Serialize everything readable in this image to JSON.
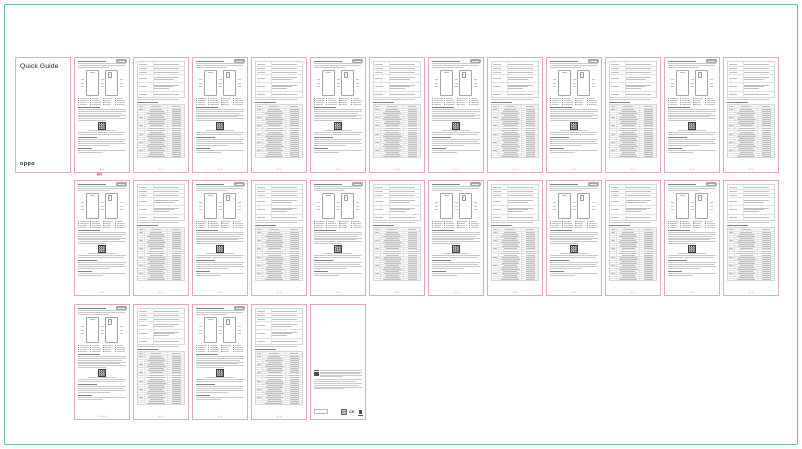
{
  "document": {
    "title": "Quick Guide"
  },
  "cover": {
    "title": "Quick Guide",
    "brand": "oppo"
  },
  "language_marker": {
    "text": "EN"
  },
  "footers": {
    "diagram": "1 / 2",
    "specs": "2 / 2",
    "multi": "1 / 2 / 3"
  },
  "regulatory": {
    "ce_mark": "CE"
  },
  "colors": {
    "frame_green": "#72bd9d",
    "page_border_pink": "#e8aab1",
    "marker_red": "#d93832",
    "language_tab_gray": "#a5a5a5"
  },
  "layout_rows": [
    {
      "name": "row-1",
      "pages": [
        "cover",
        "diagram",
        "specs",
        "diagram",
        "specs",
        "diagram",
        "specs",
        "diagram",
        "specs",
        "diagram",
        "specs",
        "diagram",
        "specs"
      ]
    },
    {
      "name": "row-2",
      "pages": [
        "diagram",
        "specs",
        "diagram",
        "specs",
        "diagram",
        "specs",
        "diagram",
        "specs",
        "diagram",
        "specs",
        "diagram",
        "specs"
      ]
    },
    {
      "name": "row-3",
      "pages": [
        "diagram",
        "specs",
        "diagram",
        "specs",
        "regulatory"
      ]
    }
  ]
}
